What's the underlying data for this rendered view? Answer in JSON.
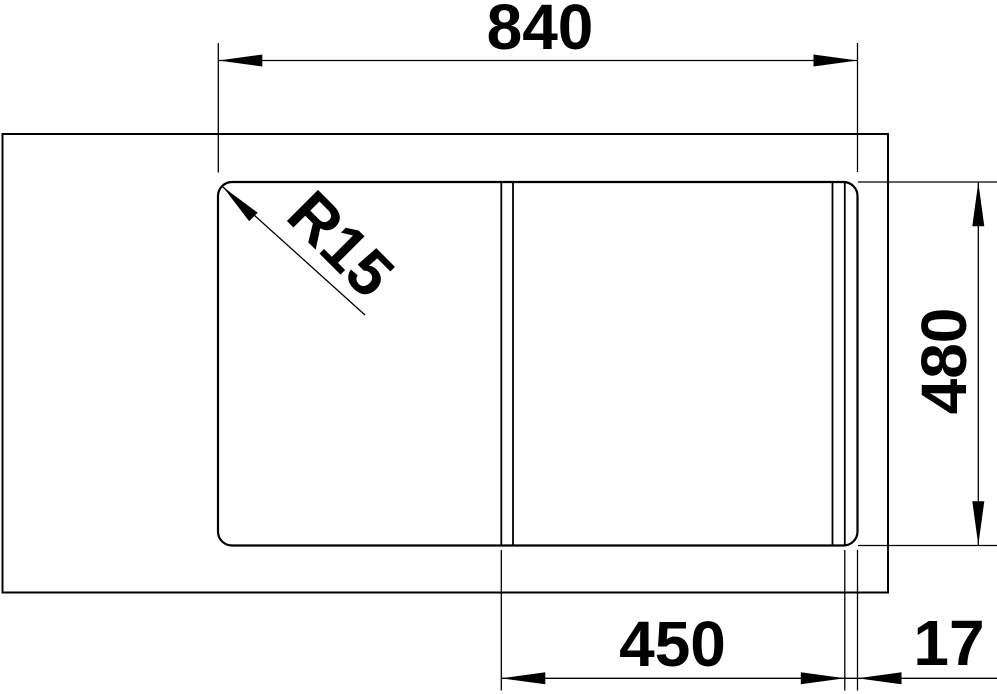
{
  "drawing": {
    "dimension_labels": {
      "overall_width": "840",
      "overall_depth": "480",
      "bowl_width": "450",
      "edge_gap": "17",
      "corner_radius": "R15"
    },
    "colors": {
      "line": "#000000",
      "background": "#ffffff"
    }
  }
}
